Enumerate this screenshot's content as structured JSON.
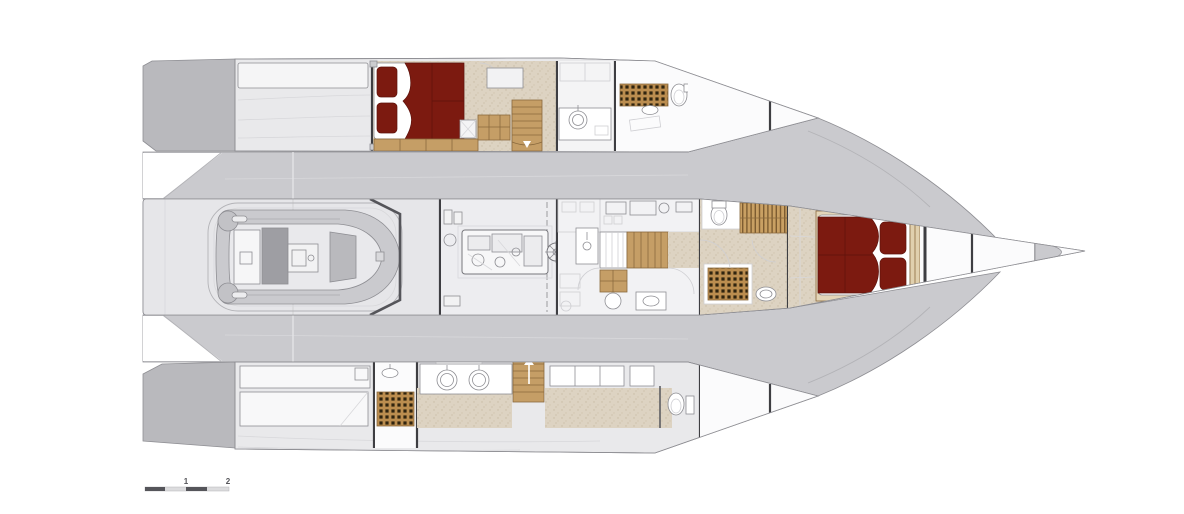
{
  "scale_bar": {
    "label_1": "1",
    "label_2": "2"
  },
  "palette": {
    "deck_dark": "#b9b9bd",
    "deck_mid": "#cacace",
    "hull_light": "#e9e9eb",
    "interior_white": "#fbfbfc",
    "carpet_beige": "#ddd3c2",
    "wood": "#c59e66",
    "wood_dark": "#8a6a3e",
    "grate_wood": "#bb8d4f",
    "grate_hole": "#30240f",
    "bed_red": "#7c1a10",
    "outline_gray": "#8e8e93",
    "bulkhead_dark": "#3e3e42"
  }
}
